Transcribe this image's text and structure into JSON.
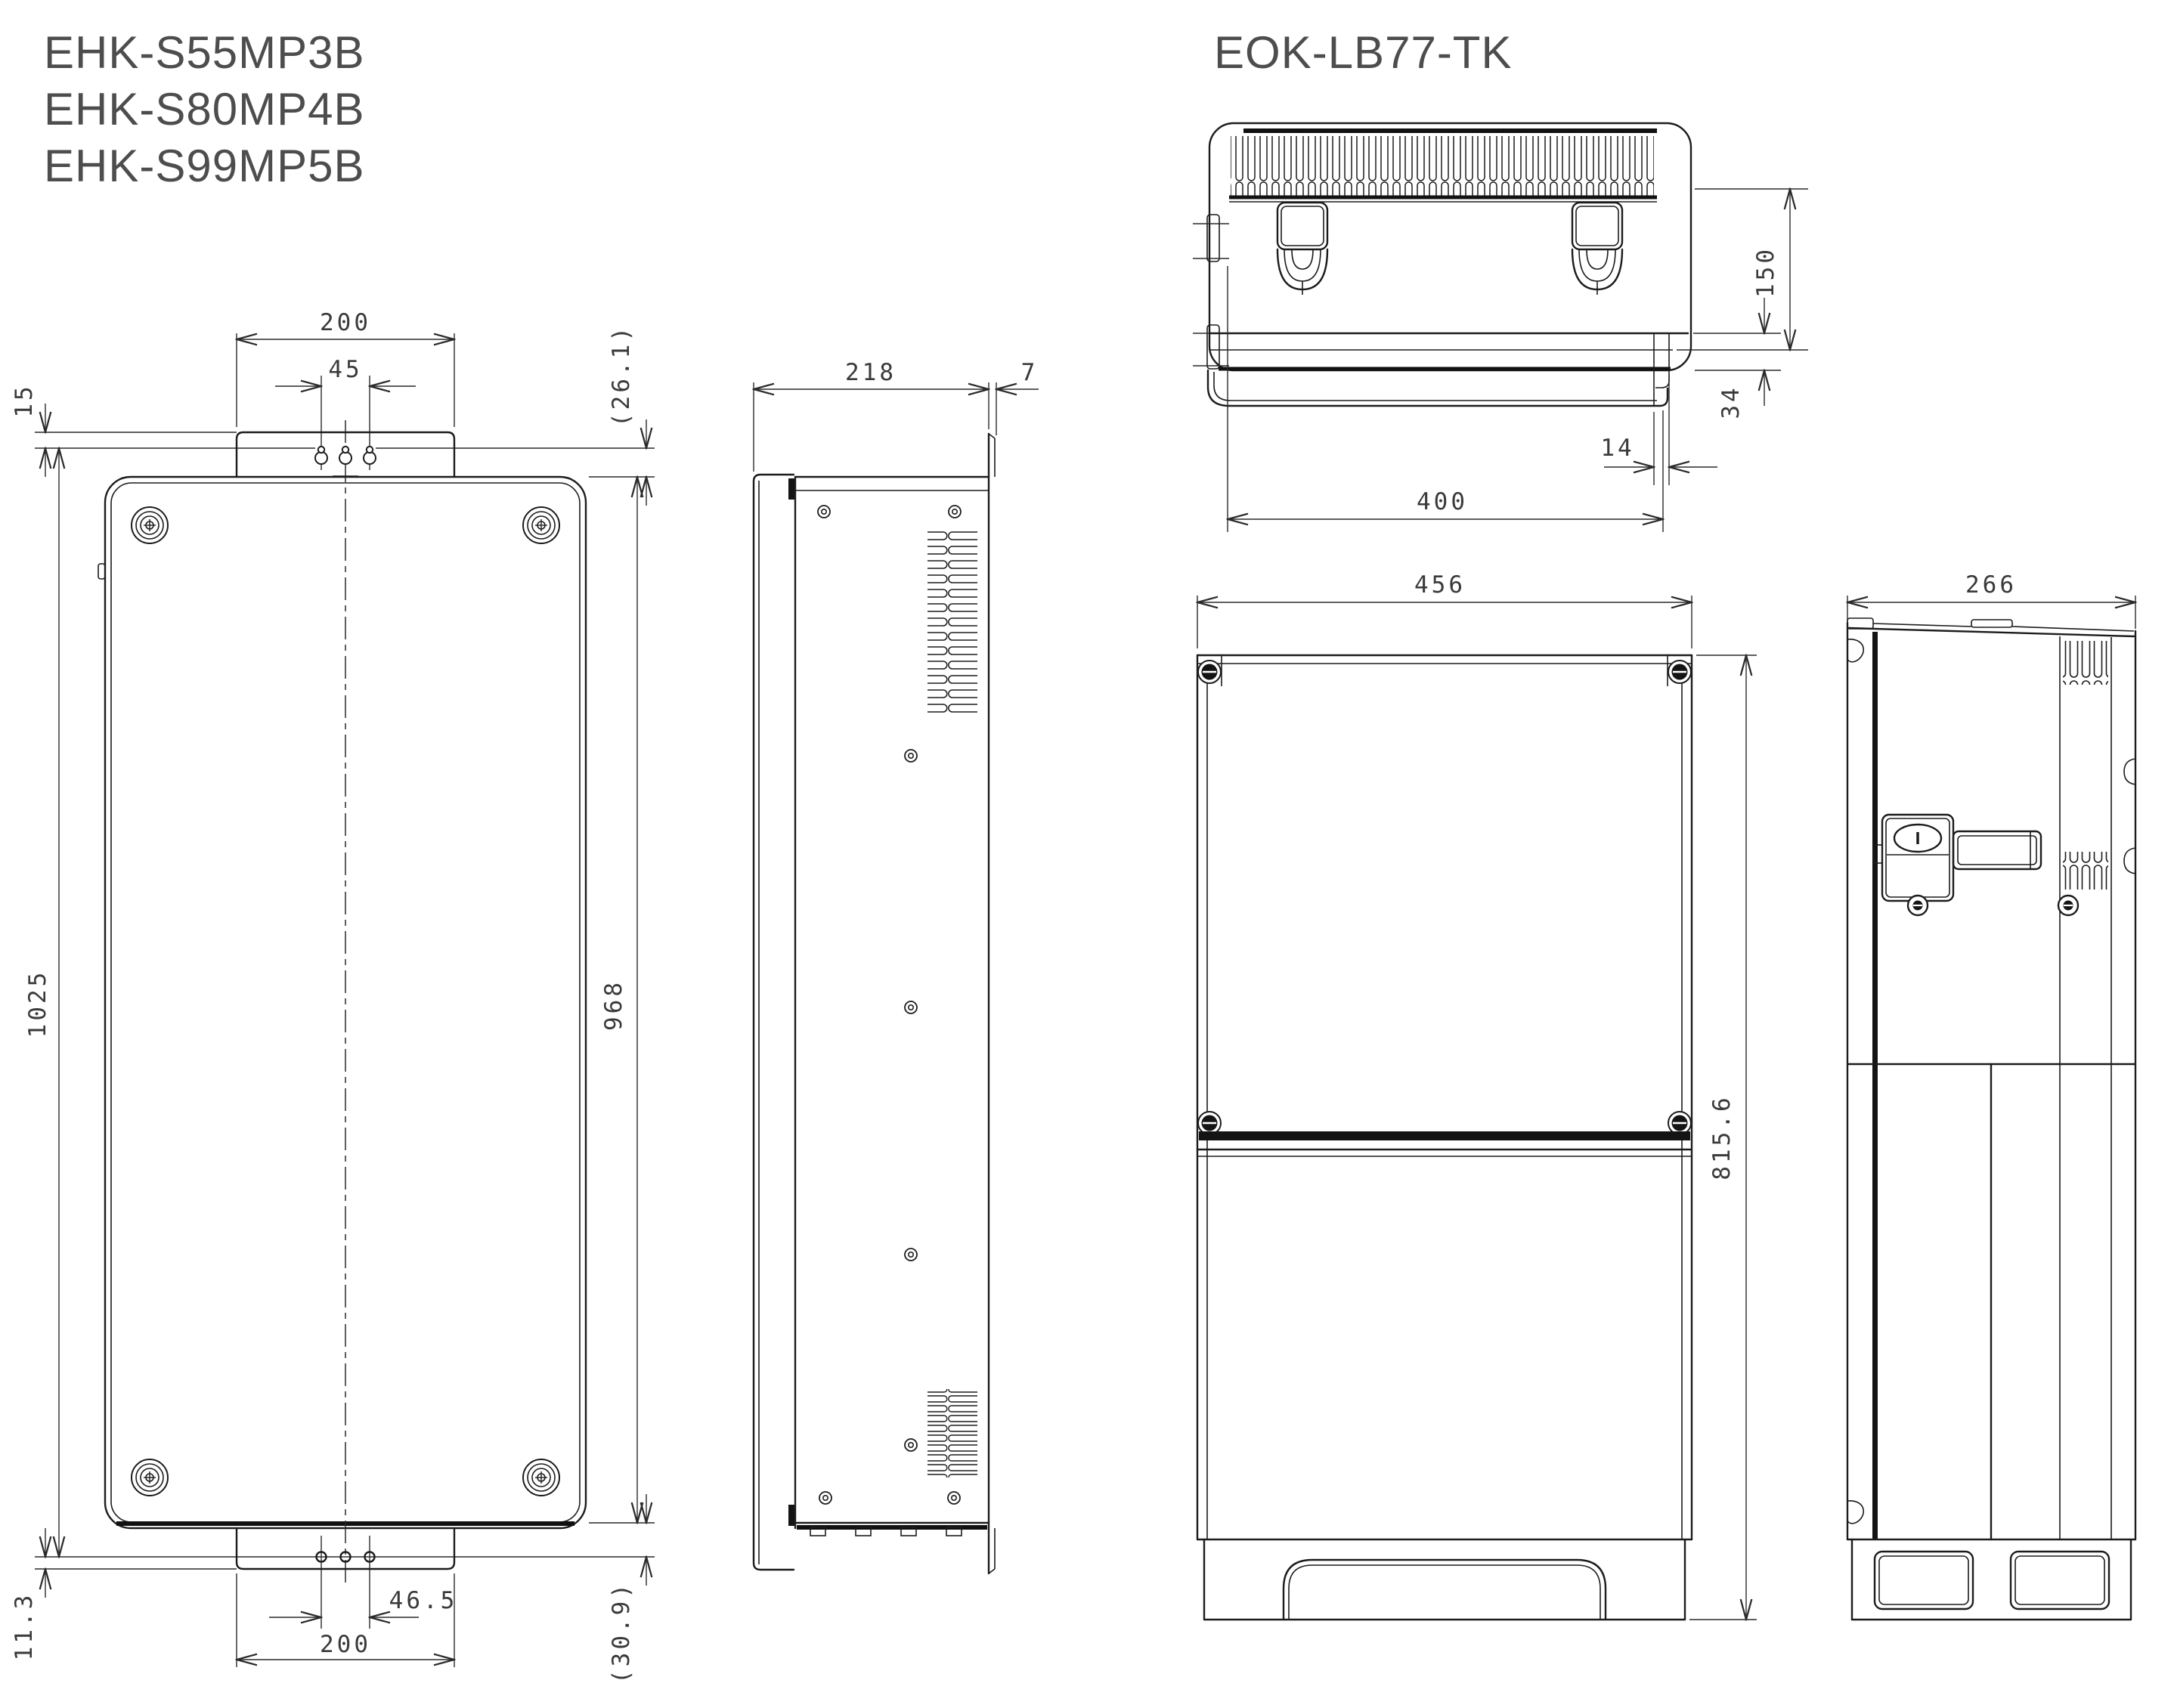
{
  "titles": {
    "left_models": [
      "EHK-S55MP3B",
      "EHK-S80MP4B",
      "EHK-S99MP5B"
    ],
    "right_model": "EOK-LB77-TK"
  },
  "ehk_front": {
    "top_bracket_width": "200",
    "top_hole_pitch": "45",
    "top_hole_offset": "15",
    "top_edge_offset": "(26.1)",
    "overall_mount_height": "1025",
    "body_height": "968",
    "bottom_hole_offset": "11.3",
    "bottom_hole_pitch": "46.5",
    "bottom_bracket_width": "200",
    "bottom_edge_offset": "(30.9)"
  },
  "ehk_side": {
    "depth": "218",
    "flange_thickness": "7"
  },
  "eok_back": {
    "hook_drop": "150",
    "rail_to_bottom": "34",
    "rail_end_offset": "14",
    "mount_width": "400"
  },
  "eok_front": {
    "width": "456",
    "height": "815.6"
  },
  "eok_side": {
    "depth": "266"
  },
  "colors": {
    "line": "#1c1c1c",
    "dim_text": "#3a3a3a",
    "title_text": "#4d4d4d",
    "background": "#ffffff"
  }
}
